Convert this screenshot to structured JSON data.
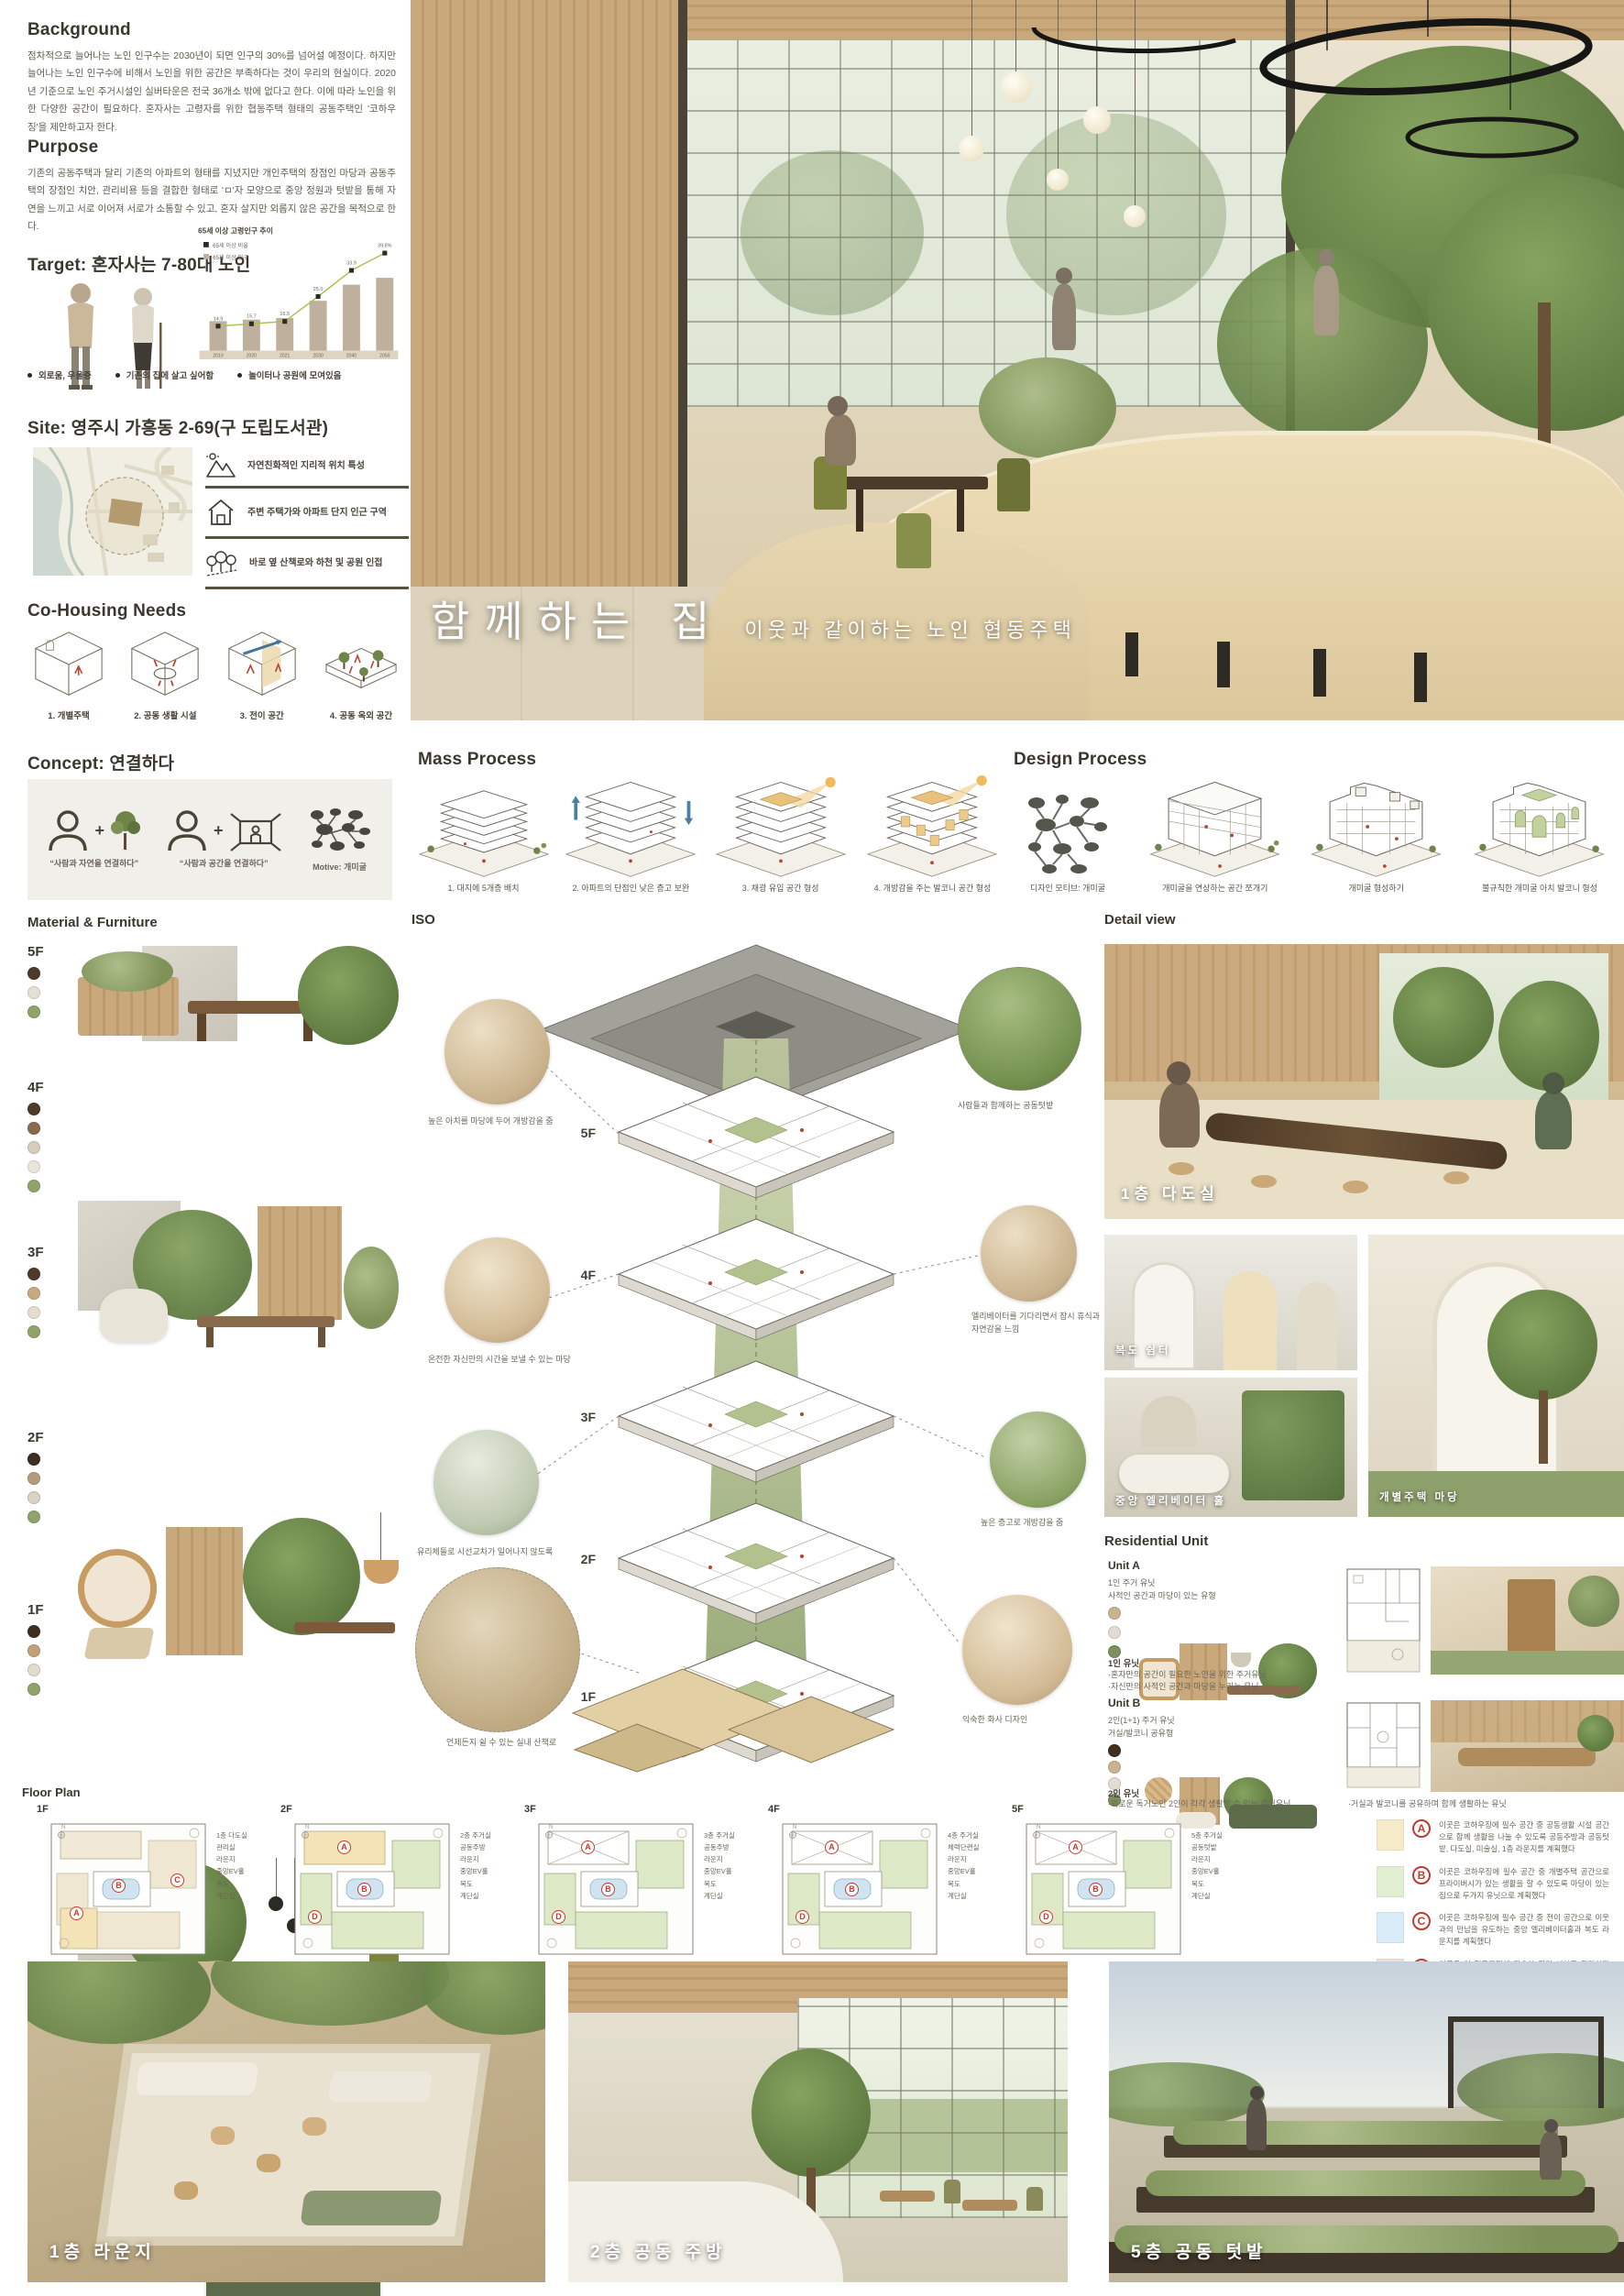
{
  "background": {
    "title": "Background",
    "text": "점차적으로 늘어나는 노인 인구수는 2030년이 되면 인구의 30%를 넘어설 예정이다. 하지만 늘어나는 노인 인구수에 비해서 노인을 위한 공간은 부족하다는 것이 우리의 현실이다. 2020년 기준으로 노인 주거시설인 실버타운은 전국 36개소 밖에 없다고 한다. 이에 따라 노인을 위한 다양한 공간이 필요하다. 혼자사는 고령자를 위한 협동주택 형태의 공동주택인 '코하우징'을 제안하고자 한다."
  },
  "purpose": {
    "title": "Purpose",
    "text": "기존의 공동주택과 달리 기존의 아파트의 형태를 지녔지만 개인주택의 장점인 마당과 공동주택의 장점인 치안, 관리비용 등을 결합한 형태로 'ㅁ'자 모양으로 중앙 정원과 텃밭을 통해 자연을 느끼고 서로 이어져 서로가 소통할 수 있고, 혼자 살지만 외롭지 않은 공간을 목적으로 한다."
  },
  "target": {
    "title": "Target: 혼자사는 7-80대 노인",
    "bullets": [
      "외로움, 우울증",
      "기존의 집에 살고 싶어함",
      "놀이터나 공원에 모여있음"
    ]
  },
  "chart_data": {
    "type": "bar",
    "title": "65세 이상 고령인구 추이",
    "categories": [
      "2019",
      "2020",
      "2021",
      "2030",
      "2040",
      "2050"
    ],
    "series": [
      {
        "name": "65세 이상 비율",
        "type": "line",
        "unit": "%",
        "values": [
          14.9,
          15.7,
          16.5,
          25.0,
          33.9,
          39.8
        ],
        "labels": [
          "14.9",
          "15.7",
          "16.5",
          "25.0",
          "33.9",
          "39.8%"
        ]
      },
      {
        "name": "65세 이상 인구",
        "type": "bar",
        "unit": "천명(추정)",
        "values": [
          7700,
          8100,
          8500,
          13000,
          17200,
          19000
        ]
      }
    ],
    "legend_position": "top-left",
    "grid": false,
    "ylim_line_pct": [
      0,
      45
    ]
  },
  "site": {
    "title": "Site: 영주시 가흥동 2-69(구 도립도서관)",
    "features": [
      {
        "icon": "mountain-icon",
        "text": "자연친화적인 지리적 위치 특성"
      },
      {
        "icon": "house-icon",
        "text": "주변 주택가와 아파트 단지 인근 구역"
      },
      {
        "icon": "trees-icon",
        "text": "바로 옆 산책로와 하천 및 공원 인접"
      }
    ]
  },
  "needs": {
    "title": "Co-Housing Needs",
    "items": [
      "1. 개별주택",
      "2. 공동 생활 시설",
      "3. 전이 공간",
      "4. 공동 옥외 공간"
    ]
  },
  "hero": {
    "title": "함께하는 집",
    "subtitle": "이웃과 같이하는 노인 협동주택"
  },
  "concept": {
    "title": "Concept: 연결하다",
    "captions": [
      "“사람과 자연을 연결하다”",
      "“사람과 공간을 연결하다”",
      "Motive: 개미굴"
    ]
  },
  "mass": {
    "title": "Mass Process",
    "steps": [
      "1. 대지에 5개층 배치",
      "2. 아파트의 단점인 낮은 층고 보완",
      "3. 채광 유입 공간 형성",
      "4. 개방감을 주는 발코니 공간 형성"
    ]
  },
  "design": {
    "title": "Design Process",
    "steps": [
      "디자인 모티브: 개미굴",
      "개미굴을 연상하는 공간 쪼개기",
      "개미굴 형성하기",
      "불규칙한 개미굴 아치 발코니 형성"
    ]
  },
  "material": {
    "title": "Material & Furniture",
    "floors": [
      {
        "label": "5F",
        "dots": [
          "#4d3a2a",
          "#e4e0d5",
          "#90a369"
        ]
      },
      {
        "label": "4F",
        "dots": [
          "#4d3a2a",
          "#8a6a4c",
          "#d8cdbd",
          "#eae5da",
          "#90a369"
        ]
      },
      {
        "label": "3F",
        "dots": [
          "#4d3a2a",
          "#c8a87e",
          "#e4ddd0",
          "#90a369"
        ]
      },
      {
        "label": "2F",
        "dots": [
          "#3d2e22",
          "#b59a7b",
          "#d9d2c5",
          "#90a369"
        ]
      },
      {
        "label": "1F",
        "dots": [
          "#3d2e22",
          "#c3a077",
          "#e2dccf",
          "#90a369"
        ]
      }
    ]
  },
  "iso": {
    "title": "ISO",
    "floors": [
      "5F",
      "4F",
      "3F",
      "2F",
      "1F"
    ],
    "left_notes": [
      "높은 아치를 마당에 두어 개방감을 줌",
      "온전한 자신만의 시간을 보낼 수 있는 마당",
      "유리체들로 시선교차가 일어나지 않도록",
      "언제든지 쉴 수 있는 실내 산책로"
    ],
    "right_notes": [
      "사람들과 함께하는 공동텃밭",
      "엘리베이터를 기다리면서 잠시 휴식과 자연감을 느낌",
      "높은 층고로 개방감을 줌",
      "익숙한 화사 디자인"
    ]
  },
  "detail": {
    "title": "Detail view",
    "captions": [
      "1층 다도실",
      "복도 쉼터",
      "중앙 엘리베이터 홀",
      "개별주택 마당"
    ]
  },
  "residential": {
    "title": "Residential Unit",
    "units": [
      {
        "name": "Unit A",
        "desc": "1인 주거 유닛\n사적인 공간과 마당이 있는 유형",
        "dots": [
          "#cbb391",
          "#e2ddd1",
          "#7e8f5d"
        ],
        "label": "1인 유닛",
        "notes": [
          "·혼자만의 공간이 필요한 노인을 위한 주거유닛",
          "·자신만의 사적인 공간과 마당을 누리는 유닛"
        ]
      },
      {
        "name": "Unit B",
        "desc": "2인(1+1) 주거 유닛\n거실/발코니 공유형",
        "dots": [
          "#402e1f",
          "#cbb391",
          "#e2ddd1",
          "#7e8f5d"
        ],
        "label": "2인 유닛",
        "notes": [
          "·외로운 독거노인 2인이 각각 생활할 수 있는 주거유닛",
          "·거실과 발코니를 공유하며 함께 생활하는 유닛"
        ]
      }
    ]
  },
  "floorplan": {
    "title": "Floor Plan",
    "plans": [
      {
        "label": "1F",
        "markers": [
          "A",
          "B",
          "C"
        ],
        "rooms": [
          "1층 다도실",
          "관리실",
          "라운지",
          "중앙EV홀",
          "복도",
          "계단실"
        ]
      },
      {
        "label": "2F",
        "markers": [
          "A",
          "B",
          "D"
        ],
        "rooms": [
          "2층 주거실",
          "공동주방",
          "라운지",
          "중앙EV홀",
          "복도",
          "계단실"
        ]
      },
      {
        "label": "3F",
        "markers": [
          "A",
          "B",
          "D"
        ],
        "rooms": [
          "3층 주거실",
          "공동주방",
          "라운지",
          "중앙EV홀",
          "복도",
          "계단실"
        ]
      },
      {
        "label": "4F",
        "markers": [
          "A",
          "B",
          "D"
        ],
        "rooms": [
          "4층 주거실",
          "체력단련실",
          "라운지",
          "중앙EV홀",
          "복도",
          "계단실"
        ]
      },
      {
        "label": "5F",
        "markers": [
          "A",
          "B",
          "D"
        ],
        "rooms": [
          "5층 주거실",
          "공동텃밭",
          "라운지",
          "중앙EV홀",
          "복도",
          "계단실"
        ]
      }
    ],
    "legend": [
      {
        "letter": "A",
        "swatch": "#f6ebc9",
        "text": "이곳은 코하우징에 필수 공간 중 공동생활 시설 공간으로 함께 생활을 나눌 수 있도록 공동주방과 공동텃밭, 다도실, 미술실, 1층 라운지를 계획했다"
      },
      {
        "letter": "B",
        "swatch": "#e2eed2",
        "text": "이곳은 코하우징에 필수 공간 중 개별주택 공간으로 프라이버시가 있는 생활을 할 수 있도록 마당이 있는 집으로 두가지 유닛으로 계획했다"
      },
      {
        "letter": "C",
        "swatch": "#d9ebf6",
        "text": "이곳은 코하우징에 필수 공간 중 전이 공간으로 이웃과의 만남을 유도하는 중앙 엘리베이터홀과 복도 라운지를 계획했다"
      },
      {
        "letter": "D",
        "swatch": "#f8dfcd",
        "text": "이곳은 이 협동주택에 필요한 관리 시설로 관리실과 화장실을 계획했다"
      }
    ]
  },
  "bottom": {
    "captions": [
      "1층 라운지",
      "2층 공동 주방",
      "5층 공동 텃밭"
    ]
  },
  "colors": {
    "accent_olive": "#55533e",
    "marker_red": "#c23b2e",
    "line_green": "#a9c24f",
    "bar_taupe": "#beb09c"
  }
}
